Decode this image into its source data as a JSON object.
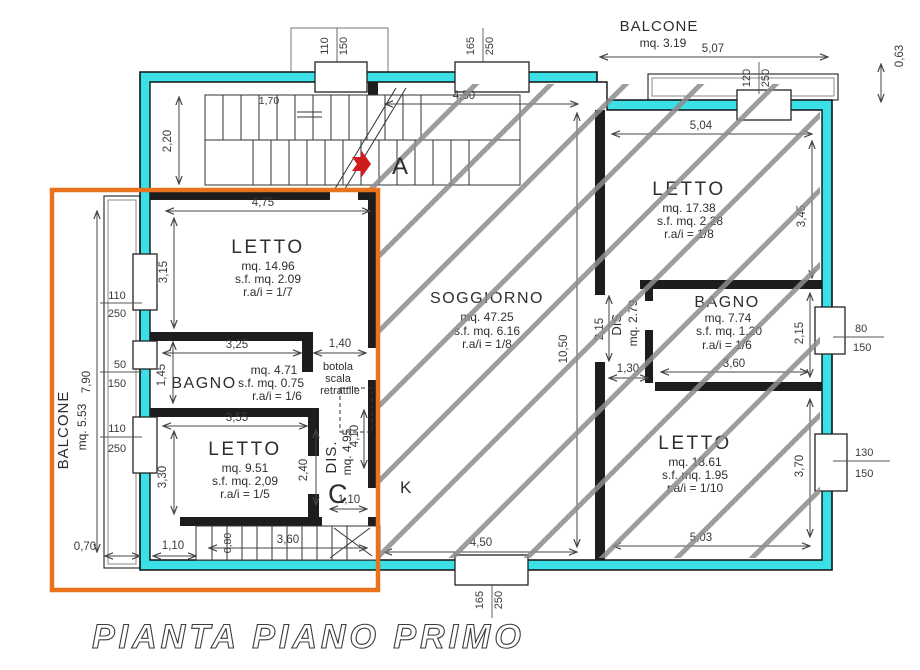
{
  "plan": {
    "title": "PIANTA PIANO PRIMO",
    "marker_a": "A",
    "marker_c": "C",
    "marker_k": "K",
    "balcone_top": {
      "label": "BALCONE",
      "area": "mq. 3.19",
      "dim_w": "5,07",
      "dim_d": "0,63"
    },
    "balcone_left": {
      "label": "BALCONE",
      "area": "mq. 5.53",
      "dim_h": "7,90",
      "dim_d": "0,70"
    },
    "letto_nw": {
      "label": "LETTO",
      "area": "mq. 14.96",
      "sf": "s.f. mq. 2.09",
      "ra": "r.a/i = 1/7",
      "dim_w": "4,75",
      "dim_h": "3,15"
    },
    "bagno_w": {
      "label": "BAGNO",
      "area": "mq. 4.71",
      "sf": "s.f. mq. 0.75",
      "ra": "r.a/i = 1/6",
      "dim_w": "3,25",
      "dim_h": "1,45",
      "dim_corridor": "1,40"
    },
    "botola": {
      "line1": "botola",
      "line2": "scala",
      "line3": "retrattile"
    },
    "letto_sw": {
      "label": "LETTO",
      "area": "mq. 9.51",
      "sf": "s.f. mq. 2,09",
      "ra": "r.a/i = 1/5",
      "dim_w": "3,55",
      "dim_h": "3,30",
      "dim_e": "2,40"
    },
    "dis_w": {
      "label": "DIS.",
      "area": "mq. 4.95",
      "dim_h": "4,10",
      "dim_door": "1,10"
    },
    "stair_top": {
      "dim_h": "2,20",
      "dim_w": "1,70"
    },
    "stair_bottom": {
      "dim_w": "3,60",
      "dim_tread": "0,80",
      "dim_left": "1,10"
    },
    "soggiorno": {
      "label": "SOGGIORNO",
      "area": "mq. 47.25",
      "sf": "s.f. mq. 6.16",
      "ra": "r.a/i = 1/8",
      "dim_w_top": "4,50",
      "dim_w_bottom": "4,50",
      "dim_h": "10,50"
    },
    "letto_ne": {
      "label": "LETTO",
      "area": "mq. 17.38",
      "sf": "s.f. mq. 2.28",
      "ra": "r.a/i = 1/8",
      "dim_w": "5,04",
      "dim_h": "3,45"
    },
    "dis_e": {
      "label": "DIS.",
      "area": "mq. 2.79",
      "dim_h": "2,15",
      "dim_door": "1,30"
    },
    "bagno_e": {
      "label": "BAGNO",
      "area": "mq. 7.74",
      "sf": "s.f. mq. 1.20",
      "ra": "r.a/i = 1/6",
      "dim_w": "3,60",
      "dim_h": "2,15"
    },
    "letto_se": {
      "label": "LETTO",
      "area": "mq. 18.61",
      "sf": "s.f. mq. 1.95",
      "ra": "r.a/i = 1/10",
      "dim_w": "5,03",
      "dim_h": "3,70"
    },
    "windows": {
      "top_left": {
        "w": "110",
        "h": "150"
      },
      "top_center": {
        "w": "165",
        "h": "250"
      },
      "top_right": {
        "w": "120",
        "h": "250"
      },
      "right_upper": {
        "w": "80",
        "h": "150"
      },
      "right_lower": {
        "w": "130",
        "h": "150"
      },
      "bottom": {
        "w": "165",
        "h": "250"
      },
      "left_upper": {
        "w": "110",
        "h": "250"
      },
      "left_middle": {
        "w": "50",
        "h": "150"
      },
      "left_lower": {
        "w": "110",
        "h": "250"
      }
    }
  },
  "colors": {
    "wall": "#3ae0e6",
    "selection": "#e8731c",
    "hatch": "#8c8c8c",
    "arrow": "#cf1b1b"
  }
}
